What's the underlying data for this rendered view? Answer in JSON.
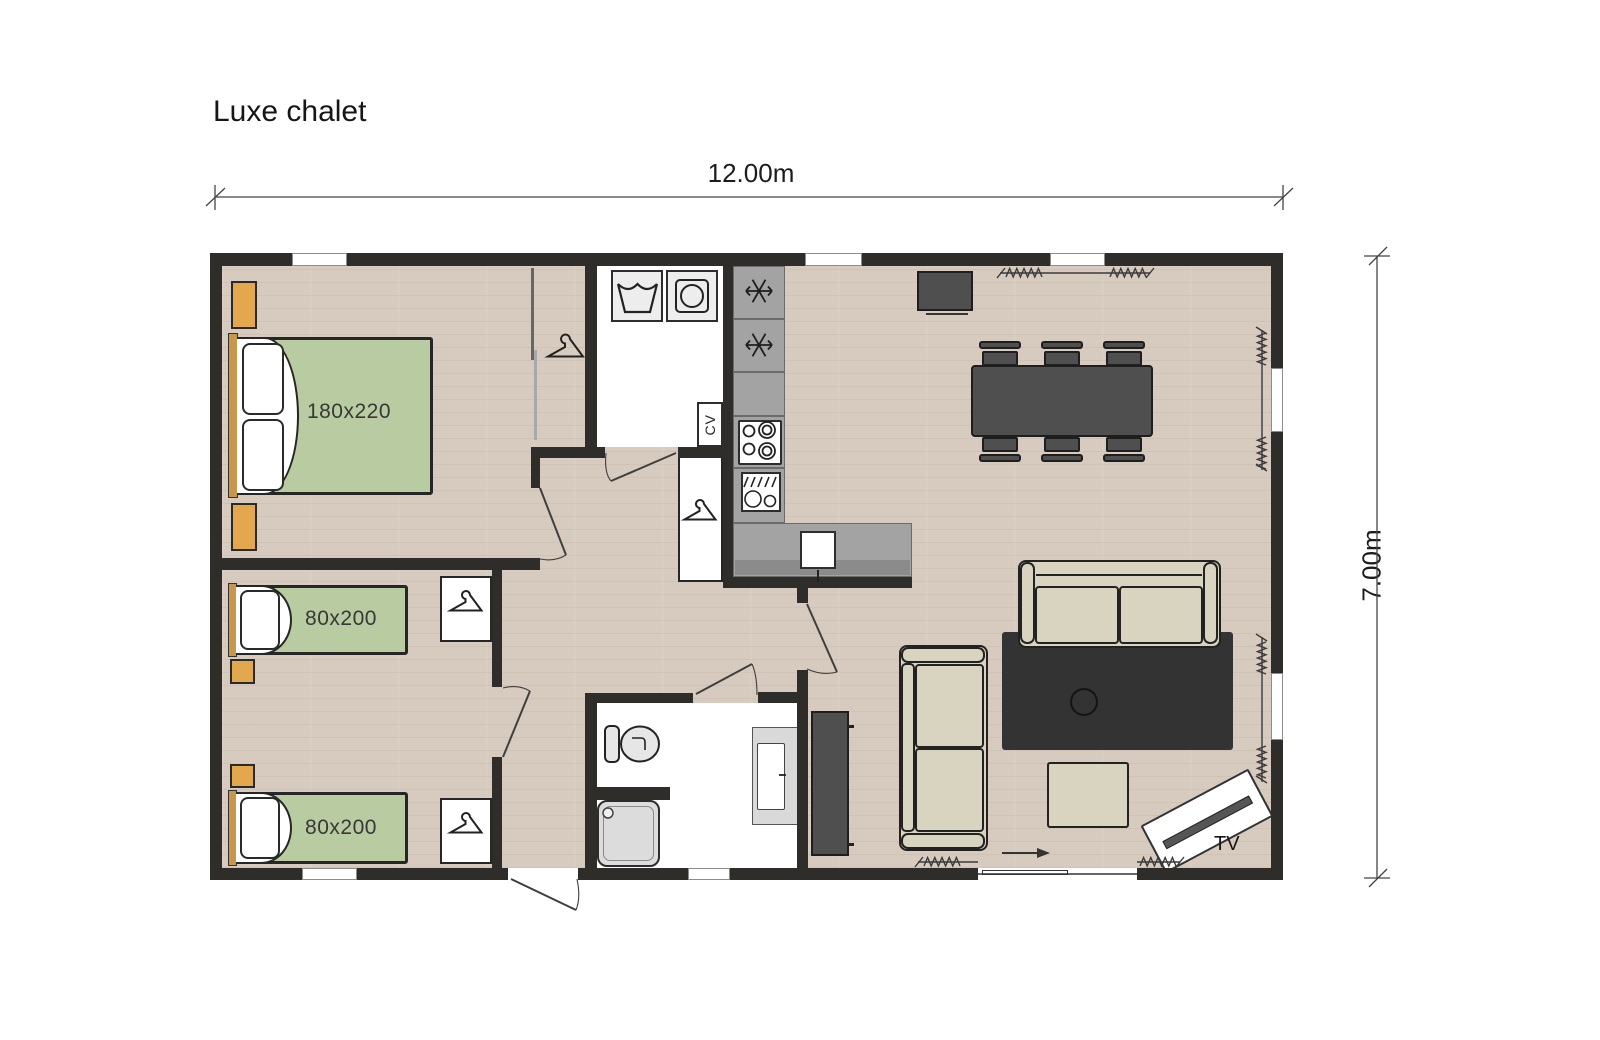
{
  "title": "Luxe chalet",
  "dimensions": {
    "width": "12.00m",
    "height": "7.00m"
  },
  "labels": {
    "master_bed": "180x220",
    "twin_bed_top": "80x200",
    "twin_bed_bottom": "80x200",
    "heater": "CV",
    "tv": "TV"
  },
  "colors": {
    "wall": "#2f2d2a",
    "wood_floor": "#d6cbbe",
    "mattress_green": "#b8cba1",
    "nightstand_orange": "#e3a84d",
    "kitchen_gray": "#a3a3a3",
    "furniture_dark": "#4f4f4f",
    "rug": "#333333",
    "sofa_beige": "#d9d4c0"
  }
}
